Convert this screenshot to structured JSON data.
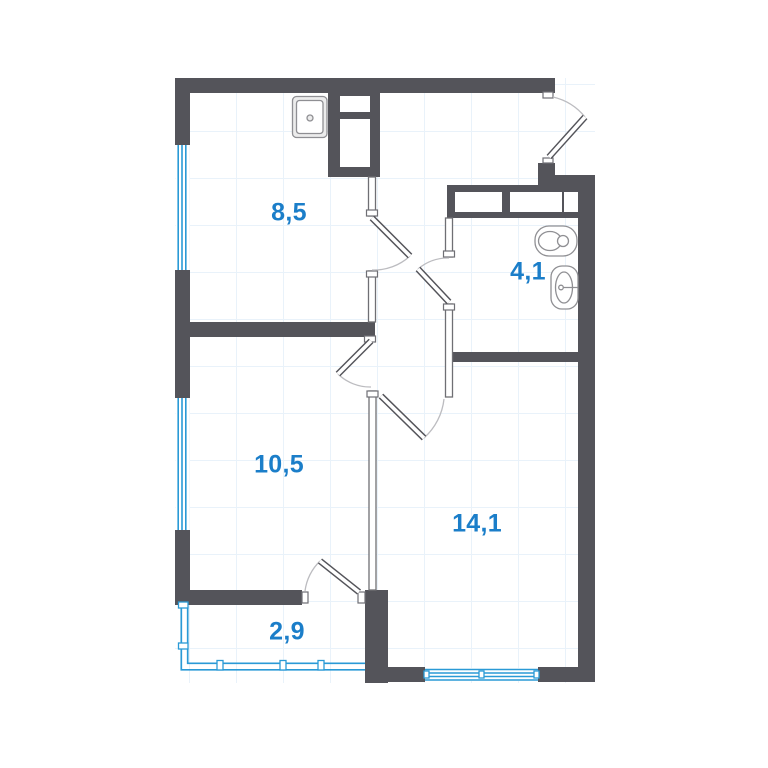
{
  "plan": {
    "rooms": [
      {
        "key": "kitchen",
        "area": "8,5"
      },
      {
        "key": "bathroom",
        "area": "4,1"
      },
      {
        "key": "room-a",
        "area": "10,5"
      },
      {
        "key": "room-b",
        "area": "14,1"
      },
      {
        "key": "balcony",
        "area": "2,9"
      }
    ],
    "fixtures": [
      "kitchen-sink-icon",
      "toilet-icon",
      "washbasin-icon",
      "vent-shaft",
      "bathroom-shaft"
    ],
    "colors": {
      "wall": "#54545a",
      "accent": "#1b7ec9",
      "glazing": "#2a9ad6",
      "grid": "#e9f2fa",
      "fixture": "#8f8f93",
      "arc": "#bcbcc0"
    }
  }
}
